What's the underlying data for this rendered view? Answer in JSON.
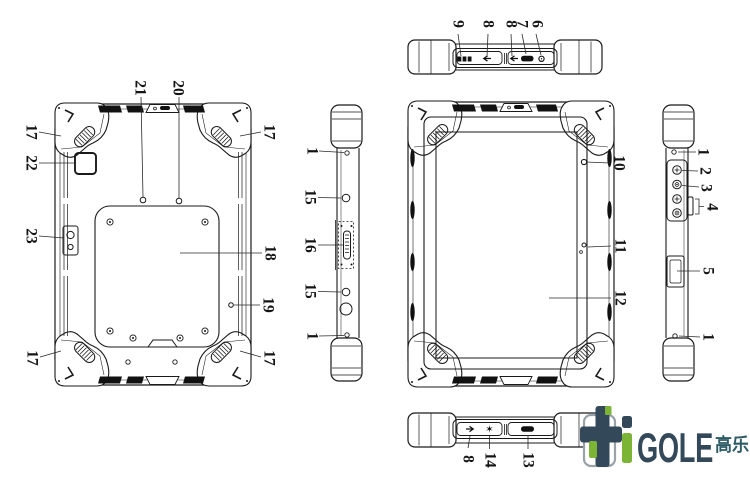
{
  "diagram": {
    "description": "Rugged tablet six-view technical line drawing with numbered callouts",
    "views": {
      "top_edge": {
        "callouts": {
          "vent": "9",
          "usb_left": "8",
          "usb_right": "8",
          "pill_port": "7",
          "audio_jack": "6"
        }
      },
      "back": {
        "callouts": {
          "bumper_tl": "17",
          "camera_window": "22",
          "flash_module": "23",
          "dot_left": "21",
          "dot_right": "20",
          "bumper_tr": "17",
          "battery_cover": "18",
          "mic_hole": "19",
          "bumper_bl": "17",
          "bumper_br": "17"
        }
      },
      "left_edge": {
        "callouts": {
          "screw_top": "1",
          "round_key_top": "15",
          "card_slot": "16",
          "round_key_bottom": "15",
          "screw_bottom": "1"
        }
      },
      "front": {
        "callouts": {
          "front_camera": "10",
          "light_sensor": "11",
          "screen": "12"
        }
      },
      "right_edge": {
        "callouts": {
          "screw_top": "1",
          "key_1": "2",
          "key_2": "3",
          "key_group": "4",
          "card_door": "5",
          "screw_bottom": "1"
        }
      },
      "bottom_edge": {
        "callouts": {
          "usb": "8",
          "star_port": "14",
          "pill_port": "13"
        }
      }
    },
    "line_color": "#1a1a1a"
  },
  "icons": {
    "star": "✶",
    "usb_arrow_left": "left-arrow",
    "usb_arrow_right": "right-arrow",
    "vent": "grille-bars",
    "audio_jack": "circle"
  },
  "logo": {
    "letter_i": "i",
    "word": "GOLE",
    "cjk": "高乐",
    "colors": {
      "dark": "#33495A",
      "green": "#7CB536",
      "gray_outline": "#98A2A7",
      "cjk_color": "#2D5B66"
    }
  }
}
